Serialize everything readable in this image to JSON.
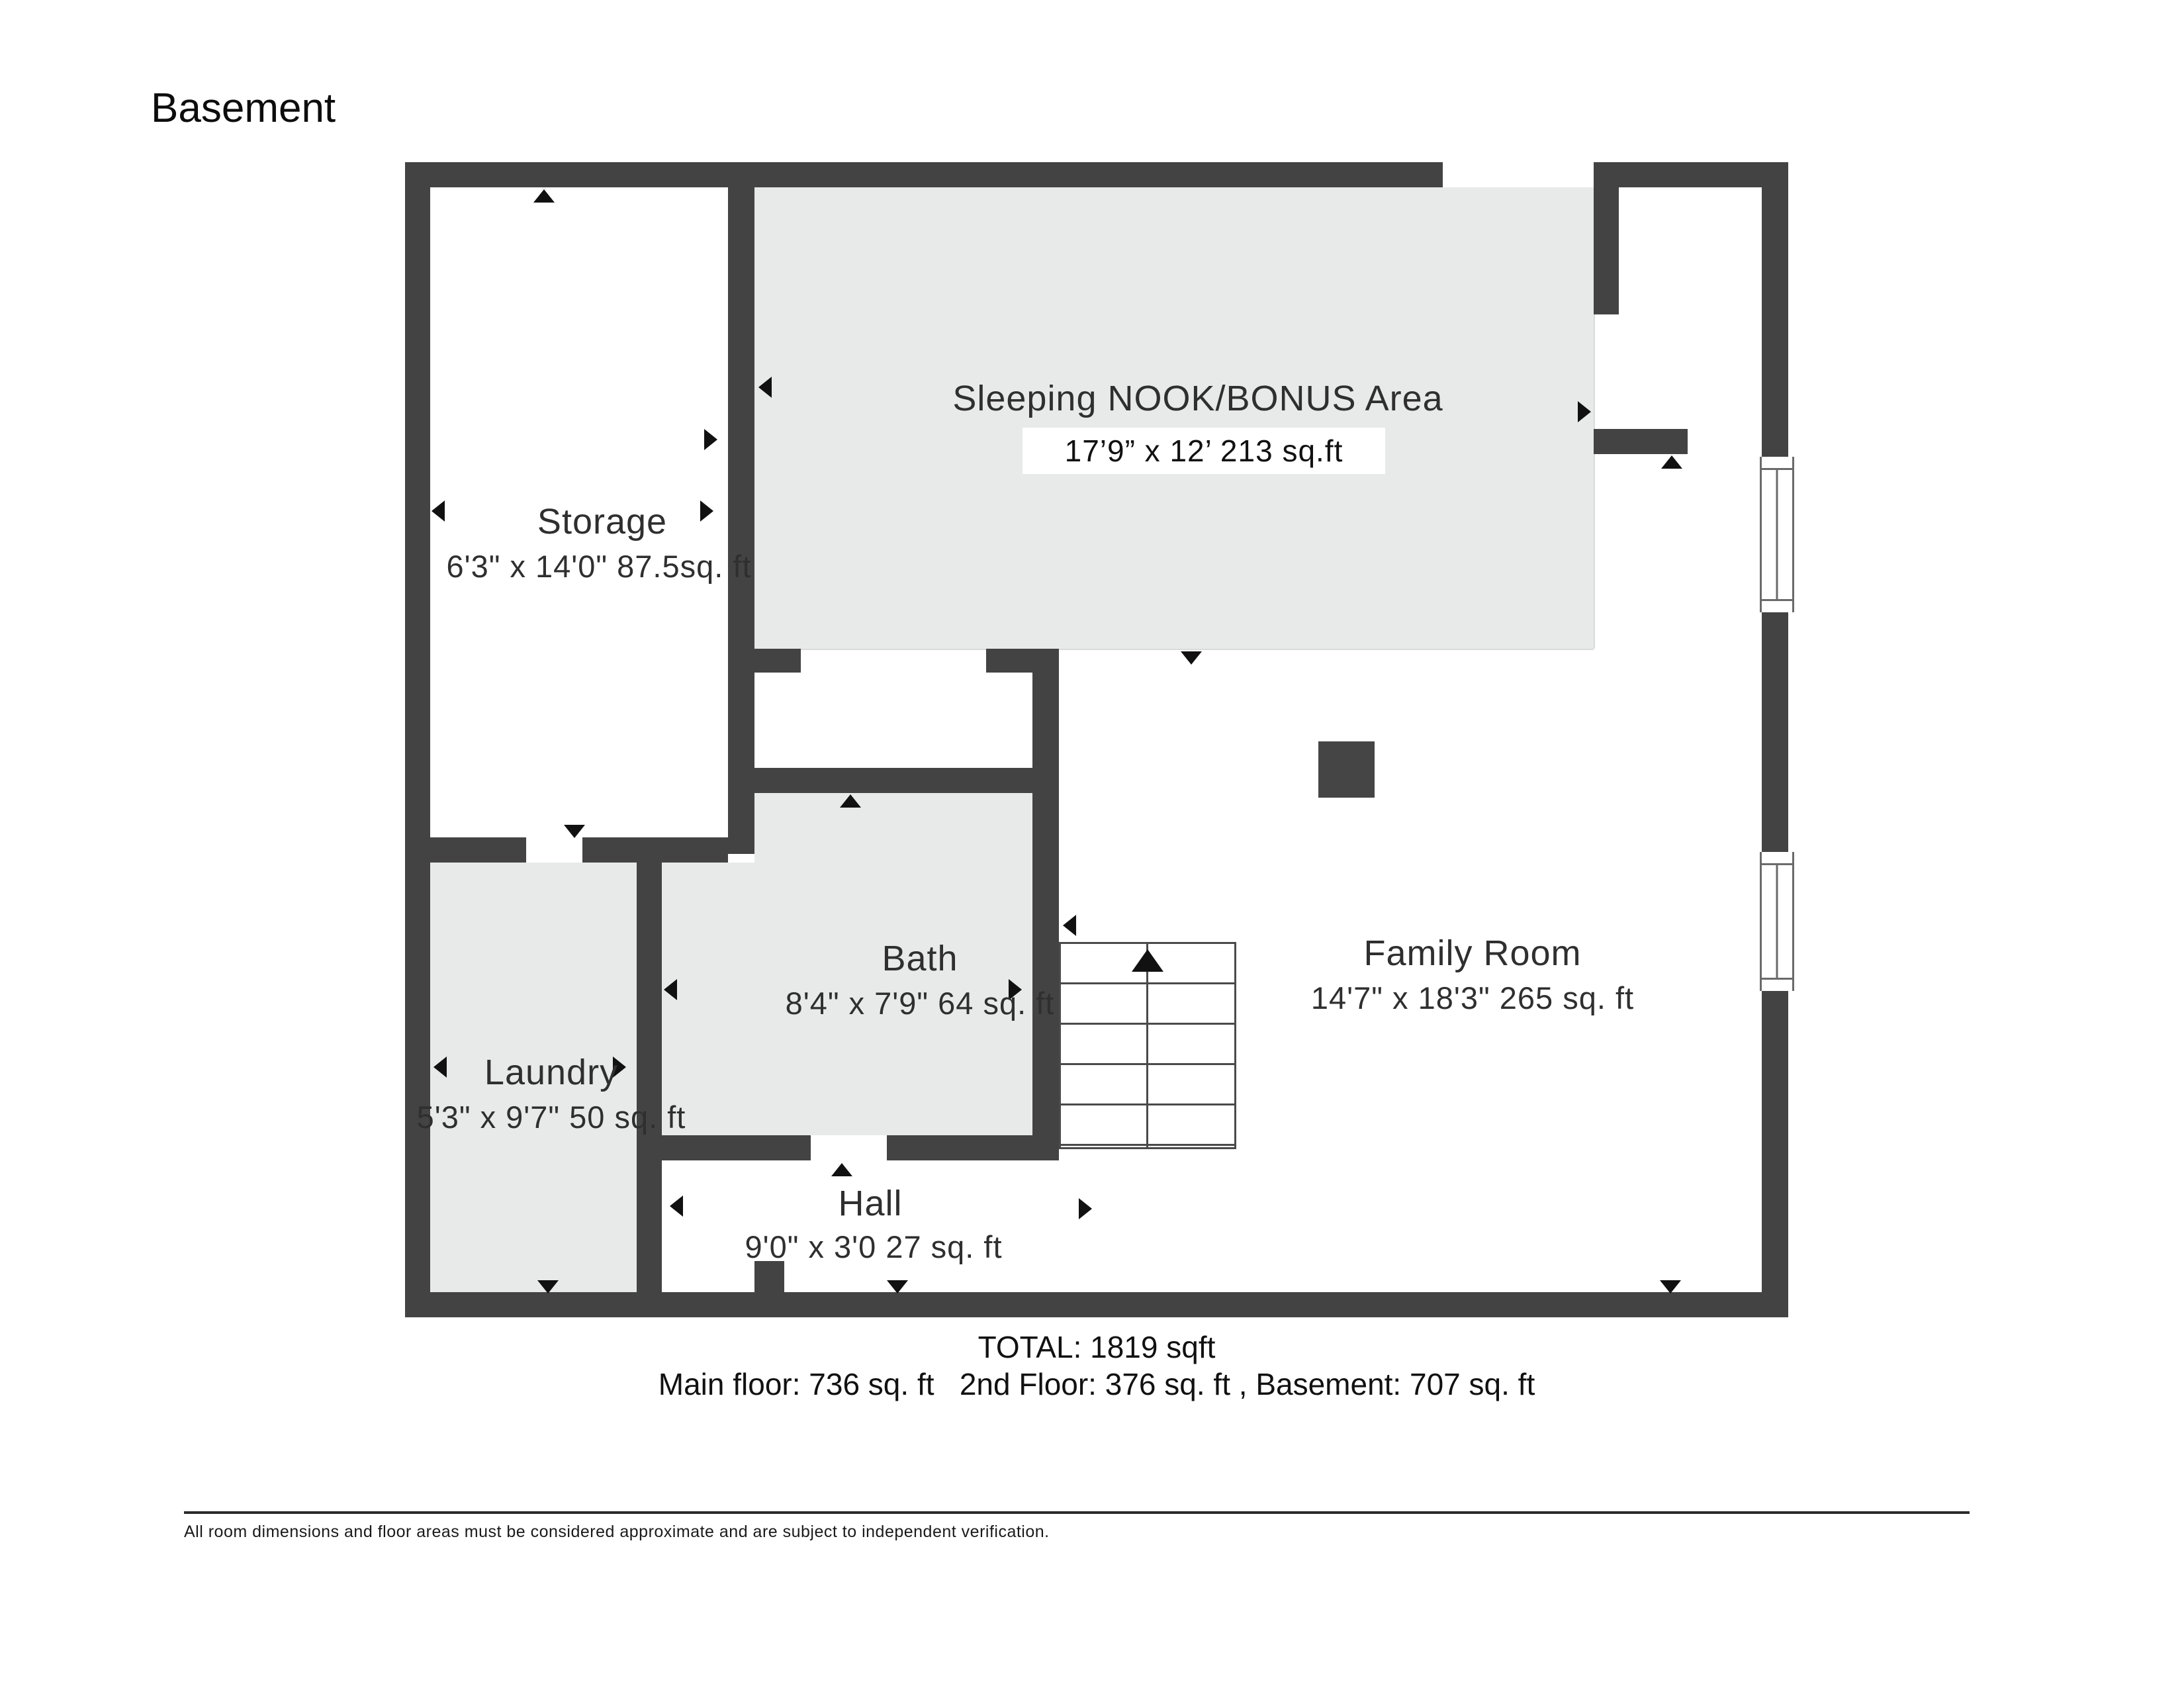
{
  "title": "Basement",
  "rooms": {
    "nook": {
      "name": "Sleeping NOOK/BONUS Area",
      "dims": "17’9” x 12’ 213 sq.ft"
    },
    "storage": {
      "name": "Storage",
      "dims": "6'3\" x 14'0\" 87.5sq. ft"
    },
    "bath": {
      "name": "Bath",
      "dims": "8'4\" x 7'9\" 64 sq. ft"
    },
    "laundry": {
      "name": "Laundry",
      "dims": "5'3\" x 9'7\" 50 sq. ft"
    },
    "hall": {
      "name": "Hall",
      "dims": "9'0\" x 3'0 27 sq. ft"
    },
    "family": {
      "name": "Family Room",
      "dims": "14'7\" x 18'3\" 265 sq. ft"
    }
  },
  "totals": {
    "total": "TOTAL: 1819 sqft",
    "breakdown": "Main floor: 736 sq. ft   2nd Floor: 376 sq. ft , Basement: 707 sq. ft"
  },
  "disclaimer": "All room dimensions and floor areas must be considered approximate and are subject to independent verification.",
  "colors": {
    "wall": "#434343",
    "room_fill": "#e8eaea"
  }
}
